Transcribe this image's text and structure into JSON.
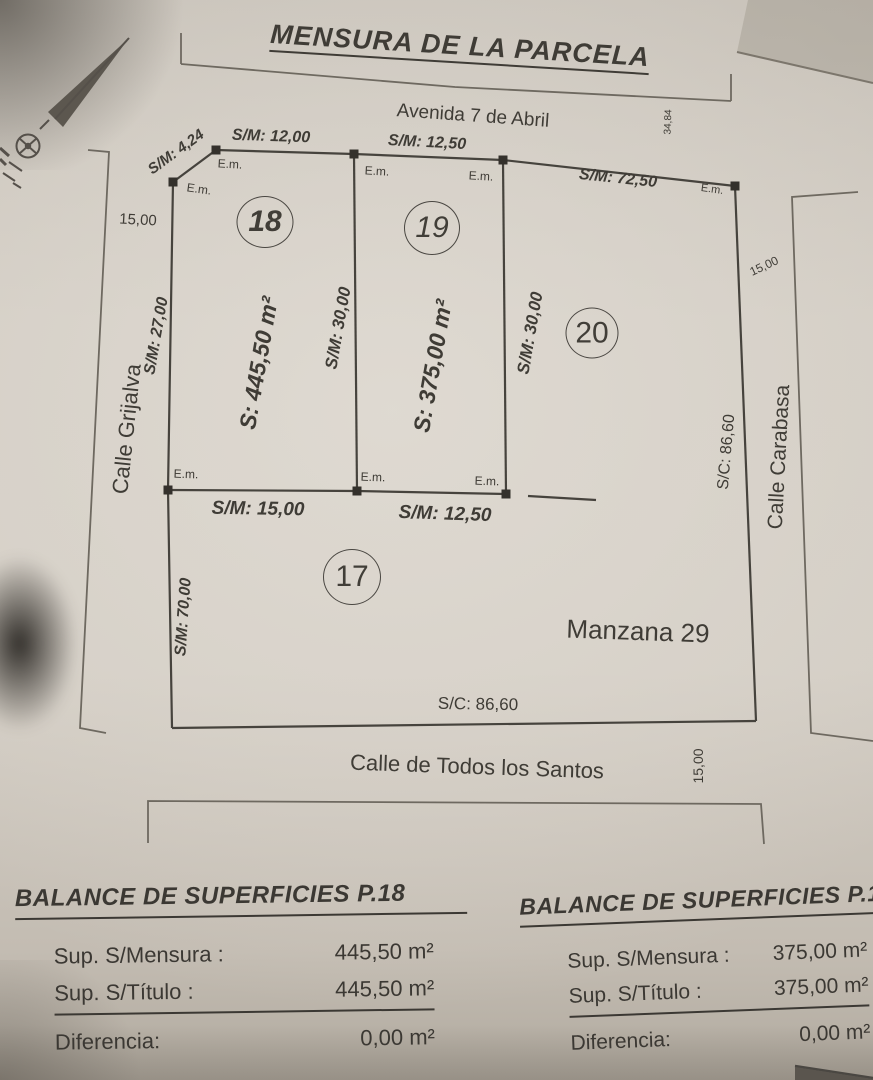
{
  "title": "MENSURA DE LA PARCELA",
  "diagram": {
    "streets": {
      "north": "Avenida 7 de Abril",
      "west": "Calle Grijalva",
      "east": "Calle Carabasa",
      "south": "Calle de Todos los Santos"
    },
    "block_label": "Manzana 29",
    "parcels": {
      "p17": "17",
      "p18": "18",
      "p19": "19",
      "p20": "20"
    },
    "areas": {
      "p18": "S: 445,50 m²",
      "p19": "S: 375,00 m²"
    },
    "measurements": {
      "chamfer": "S/M: 4,24",
      "front_p18": "S/M: 12,00",
      "front_p19": "S/M: 12,50",
      "front_east": "S/M: 72,50",
      "side_west_p18": "S/M: 27,00",
      "divider_p18_p19": "S/M: 30,00",
      "side_east_p19": "S/M: 30,00",
      "back_p18": "S/M: 15,00",
      "back_p19": "S/M: 12,50",
      "side_west_lower": "S/M: 70,00",
      "block_east": "S/C: 86,60",
      "block_south": "S/C: 86,60",
      "street_width_west": "15,00",
      "street_width_east": "15,00",
      "street_width_south": "15,00",
      "depth_right": "34,84",
      "corner_marker": "E.m."
    }
  },
  "tables": [
    {
      "title": "BALANCE DE SUPERFICIES P.18",
      "rows": [
        {
          "label": "Sup. S/Mensura :",
          "value": "445,50 m²"
        },
        {
          "label": "Sup. S/Título :",
          "value": "445,50 m²"
        },
        {
          "label": "Diferencia:",
          "value": "0,00 m²"
        }
      ]
    },
    {
      "title": "BALANCE DE SUPERFICIES P.19",
      "rows": [
        {
          "label": "Sup. S/Mensura :",
          "value": "375,00 m²"
        },
        {
          "label": "Sup. S/Título :",
          "value": "375,00 m²"
        },
        {
          "label": "Diferencia:",
          "value": "0,00 m²"
        }
      ]
    }
  ]
}
